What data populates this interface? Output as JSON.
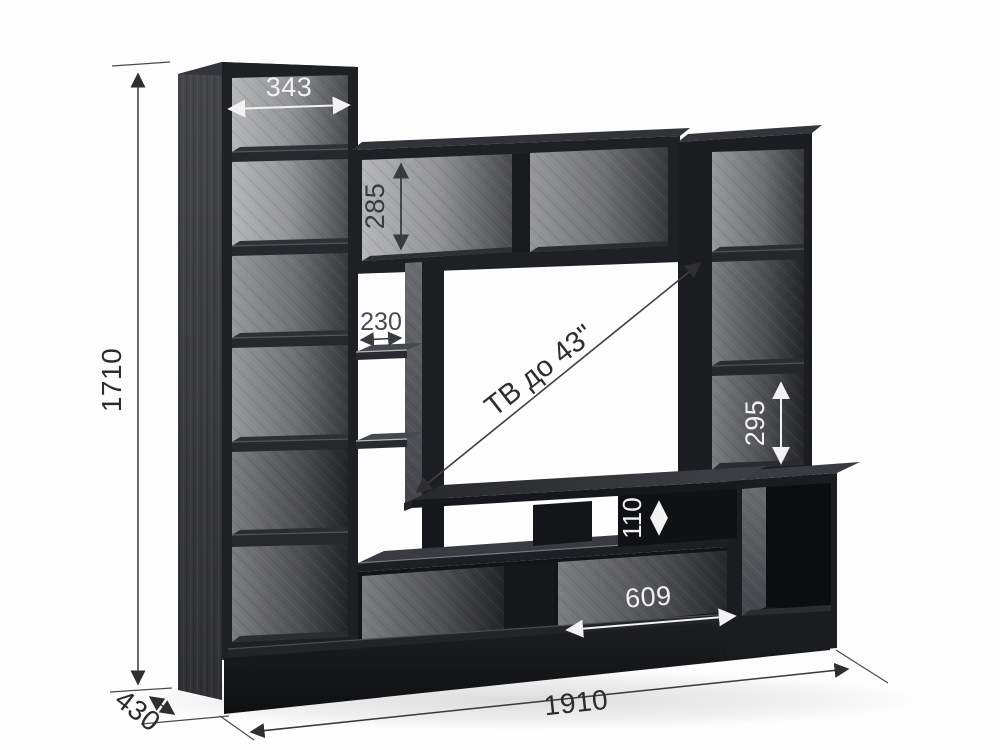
{
  "drawing": {
    "dimensions": {
      "total_height": "1710",
      "total_width": "1910",
      "depth": "430",
      "top_shelf_width": "343",
      "hutch_height": "285",
      "side_shelf_width": "230",
      "right_shelf_height": "295",
      "niche_height": "110",
      "bottom_niche_width": "609"
    },
    "tv_note": "ТВ до 43\"",
    "colors": {
      "body_dark": "#1f2023",
      "panel_light": "#b5b6b8",
      "dim_white": "#f2f2f3",
      "dim_dark": "#3a3b3d",
      "dim_black": "#2c2c2e"
    }
  }
}
